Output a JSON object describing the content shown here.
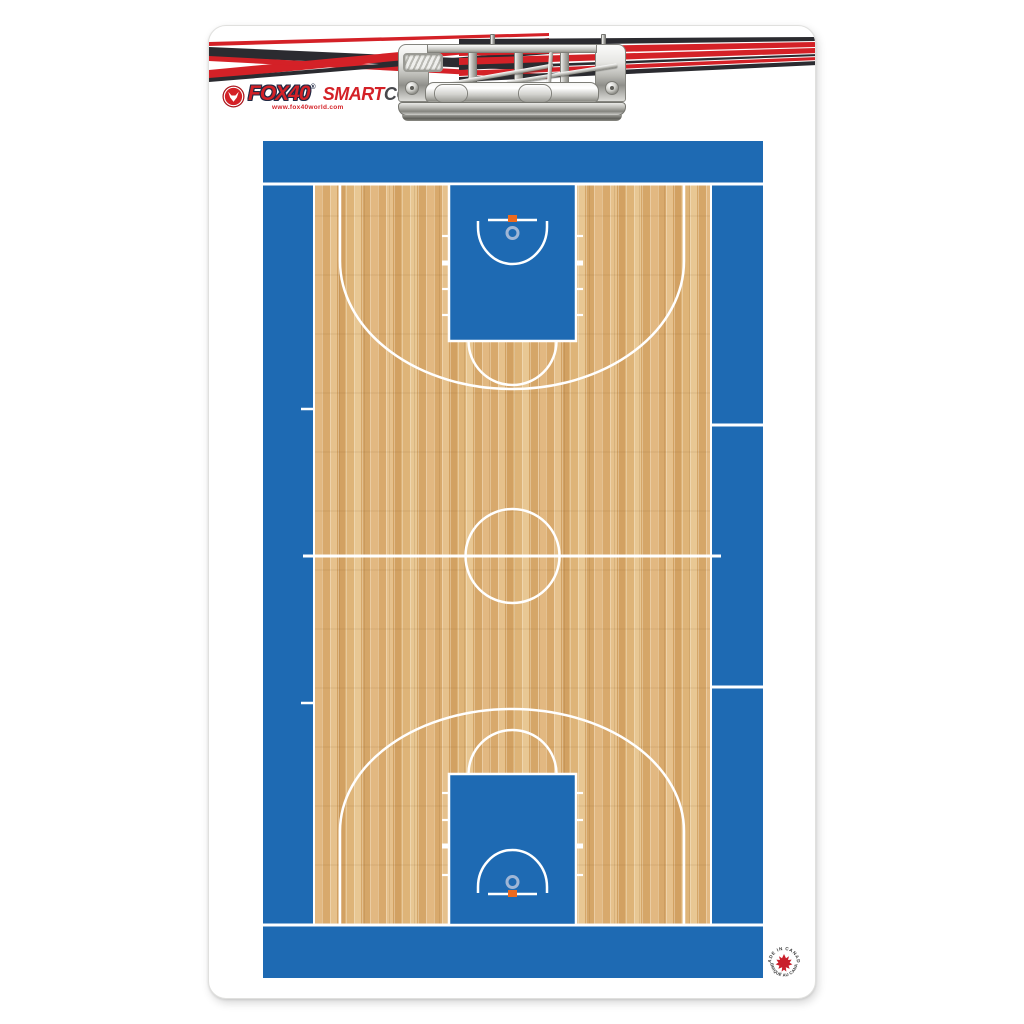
{
  "product": {
    "kind": "basketball coaching clipboard product photo",
    "board_surface": "dry-erase basketball full court"
  },
  "branding": {
    "brand": "FOX40",
    "brand_reg": "®",
    "smart": "SMART",
    "coach": "COACH",
    "coach_tm": "™",
    "website": "www.fox40world.com"
  },
  "badge": {
    "arc_top": "MADE IN CANADA",
    "arc_bottom": "FABRIQUÉ AU CANADA"
  },
  "colors": {
    "court_blue": "#1e6ab3",
    "wood_tan": "#d9ac70",
    "line_white": "#ffffff",
    "brand_red": "#d42127",
    "stripe_black": "#2b2b30",
    "rim_orange": "#ed6a1d",
    "rim_ring_blue": "#9fb6d6",
    "badge_red": "#c9202c",
    "clip_chrome": "#c9c9c5"
  }
}
